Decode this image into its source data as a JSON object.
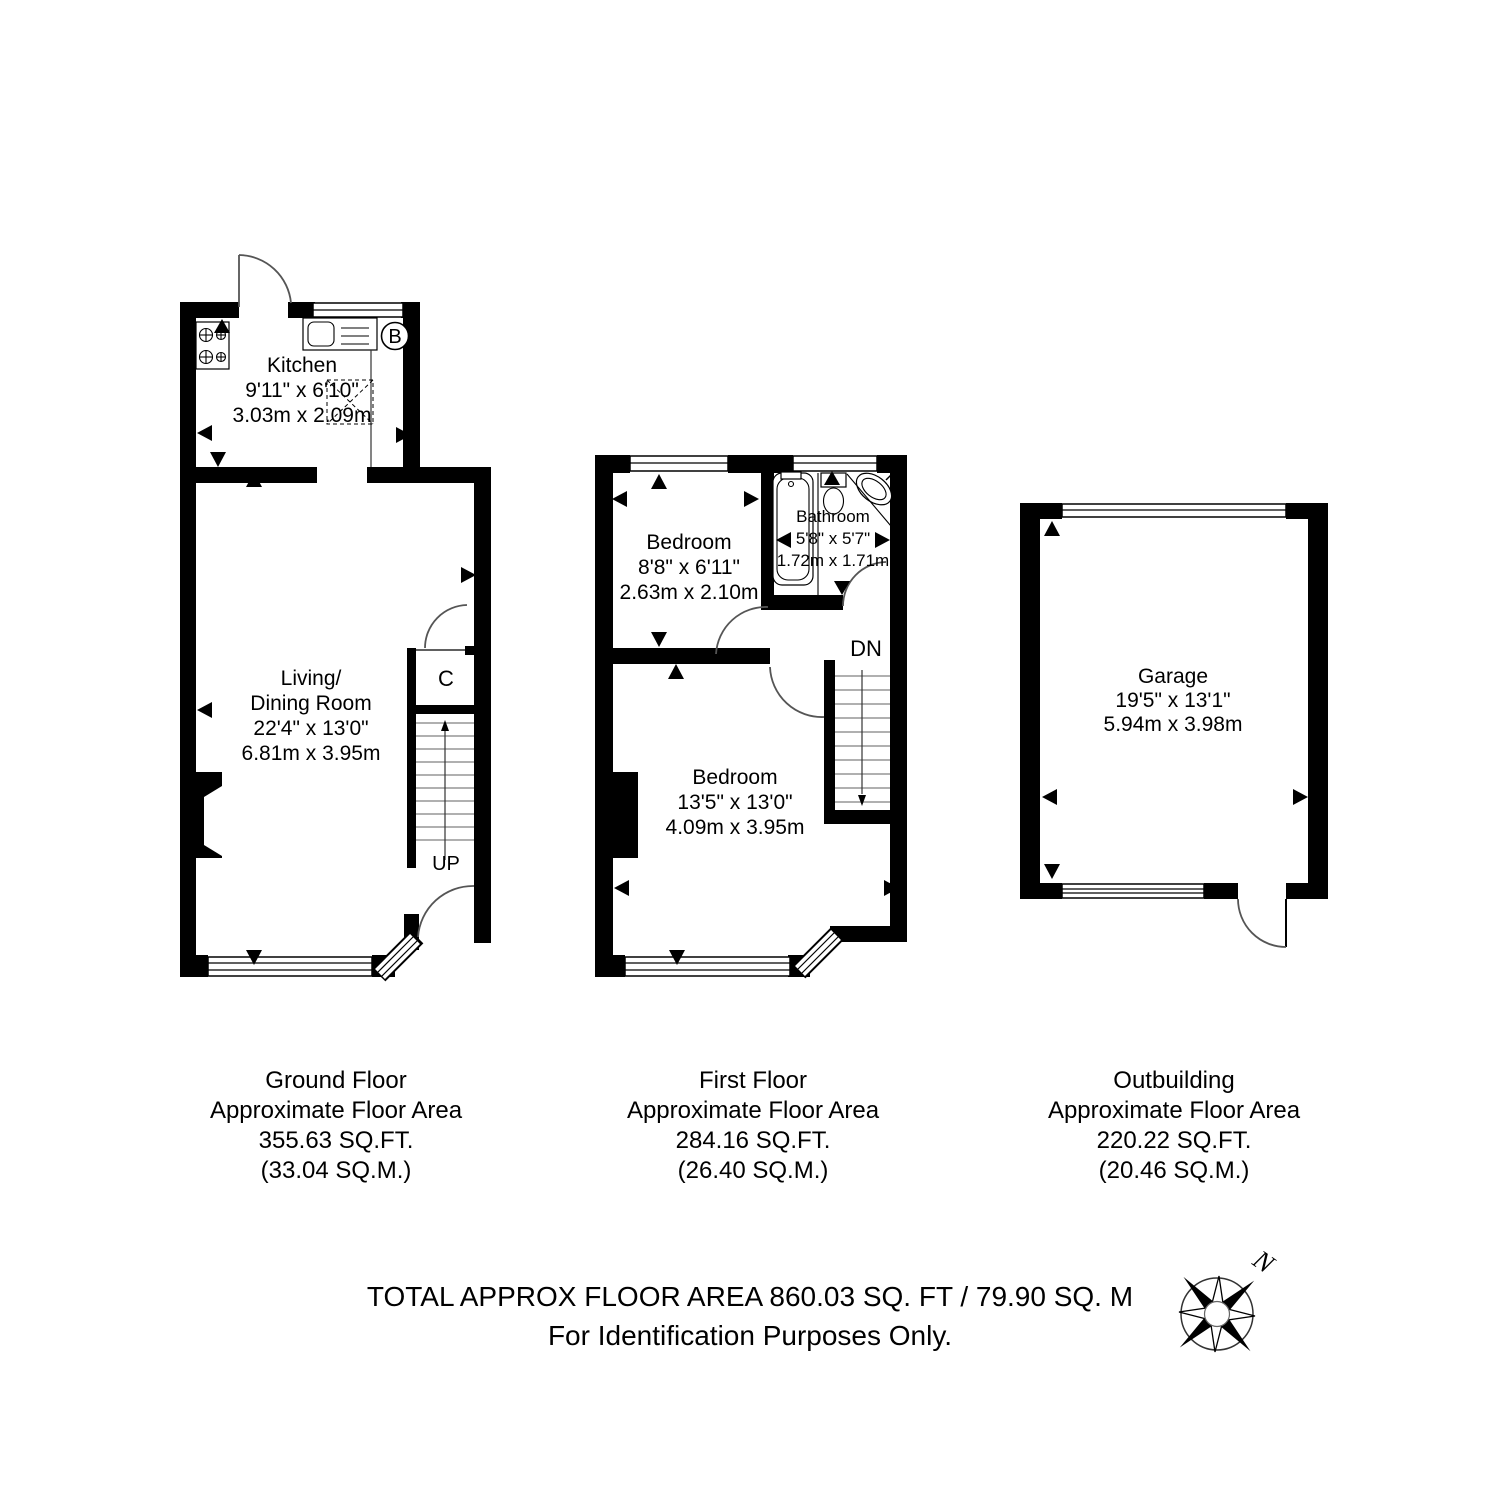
{
  "ground_floor": {
    "caption": [
      "Ground Floor",
      "Approximate Floor Area",
      "355.63 SQ.FT.",
      "(33.04 SQ.M.)"
    ],
    "kitchen": {
      "name": "Kitchen",
      "size_imperial": "9'11\" x 6'10\"",
      "size_metric": "3.03m x 2.09m"
    },
    "living_dining": {
      "name_line1": "Living/",
      "name_line2": "Dining Room",
      "size_imperial": "22'4\" x 13'0\"",
      "size_metric": "6.81m x 3.95m"
    },
    "boiler_label": "B",
    "cupboard_label": "C",
    "stairs_label": "UP"
  },
  "first_floor": {
    "caption": [
      "First Floor",
      "Approximate Floor Area",
      "284.16 SQ.FT.",
      "(26.40 SQ.M.)"
    ],
    "bedroom_front": {
      "name": "Bedroom",
      "size_imperial": "8'8\" x 6'11\"",
      "size_metric": "2.63m x 2.10m"
    },
    "bathroom": {
      "name": "Bathroom",
      "size_imperial": "5'8\" x 5'7\"",
      "size_metric": "1.72m x 1.71m"
    },
    "bedroom_rear": {
      "name": "Bedroom",
      "size_imperial": "13'5\" x 13'0\"",
      "size_metric": "4.09m x 3.95m"
    },
    "stairs_label": "DN"
  },
  "outbuilding": {
    "caption": [
      "Outbuilding",
      "Approximate Floor Area",
      "220.22 SQ.FT.",
      "(20.46 SQ.M.)"
    ],
    "garage": {
      "name": "Garage",
      "size_imperial": "19'5\" x 13'1\"",
      "size_metric": "5.94m x 3.98m"
    }
  },
  "footer": {
    "total_line": "TOTAL APPROX FLOOR AREA 860.03 SQ. FT / 79.90 SQ. M",
    "note_line": "For Identification Purposes Only.",
    "compass_north_label": "N"
  },
  "colors": {
    "wall": "#000000",
    "background": "#ffffff",
    "door_arc": "#555555",
    "text": "#000000"
  }
}
